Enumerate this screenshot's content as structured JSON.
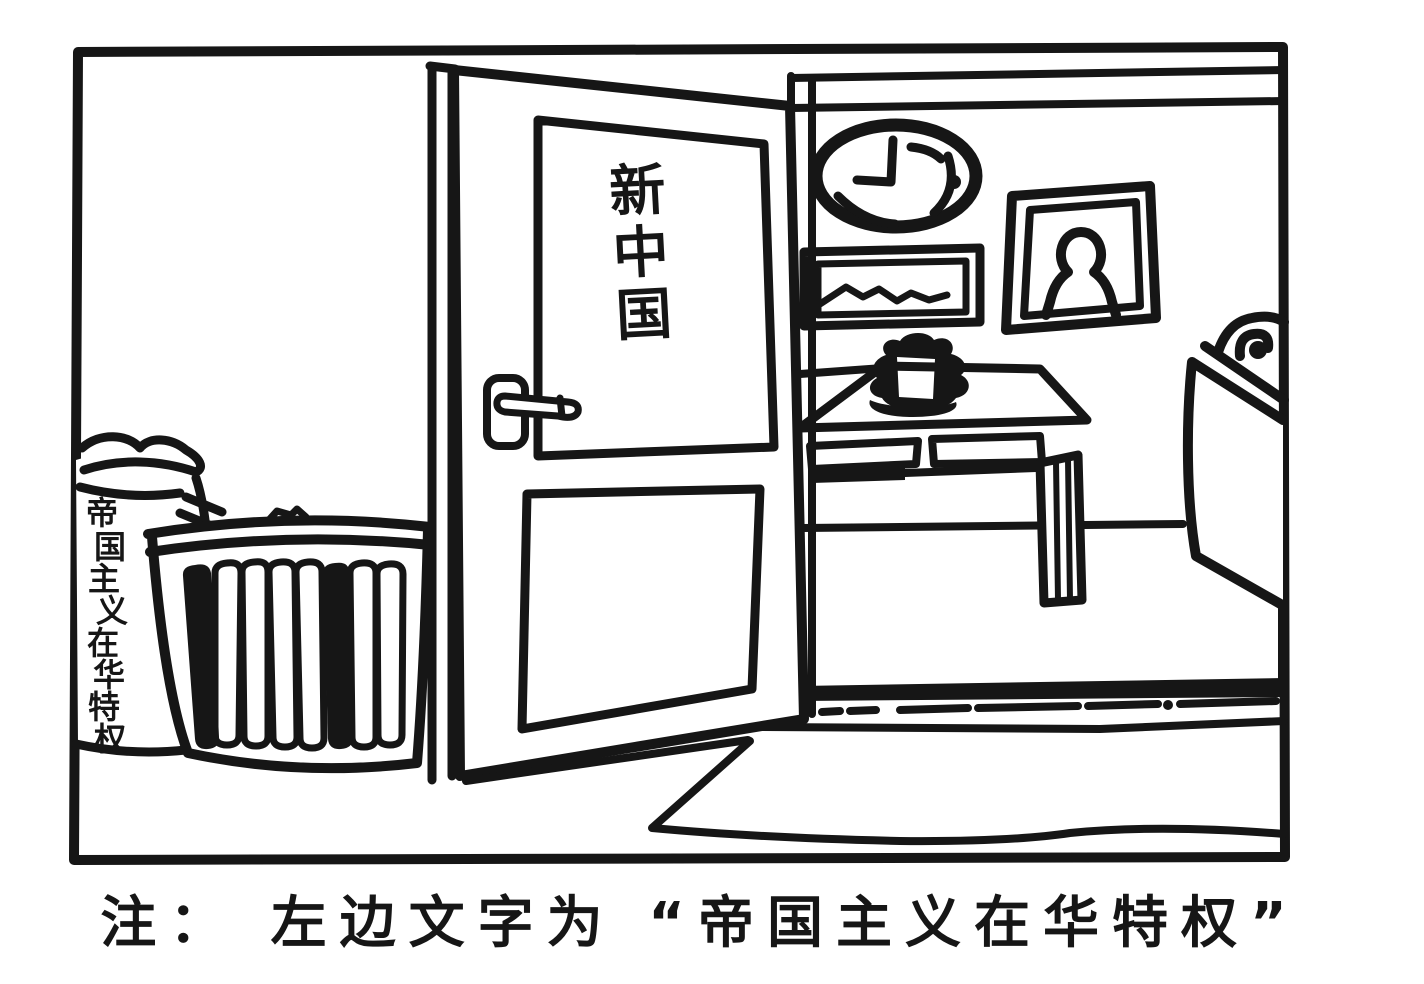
{
  "canvas": {
    "background": "#ffffff",
    "ink": "#161616",
    "style": "hand-drawn black-and-white political cartoon"
  },
  "door_sign": {
    "orientation": "vertical",
    "text": "新中国",
    "chars": [
      "新",
      "中",
      "国"
    ]
  },
  "sack_label": {
    "orientation": "vertical",
    "text": "帝国主义在华特权",
    "chars": [
      "帝",
      "国",
      "主",
      "义",
      "在",
      "华",
      "特",
      "权"
    ]
  },
  "caption": {
    "text": "注： 左边文字为 “帝国主义在华特权”"
  },
  "objects": {
    "frame": "panel border",
    "door": "open door with vertical sign",
    "door_handle": "lever door handle",
    "wastebasket": "slatted wastebasket",
    "sack": "crumpled sack leaning on frame",
    "wall_clock": "oval wall clock",
    "landscape_picture": "framed landscape picture",
    "portrait_picture": "framed portrait picture",
    "table": "table with two drawers",
    "teapot": "teapot on saucer",
    "cabinet": "cabinet against right wall",
    "rug": "floor mat",
    "baseboard": "dark baseboard strip"
  }
}
